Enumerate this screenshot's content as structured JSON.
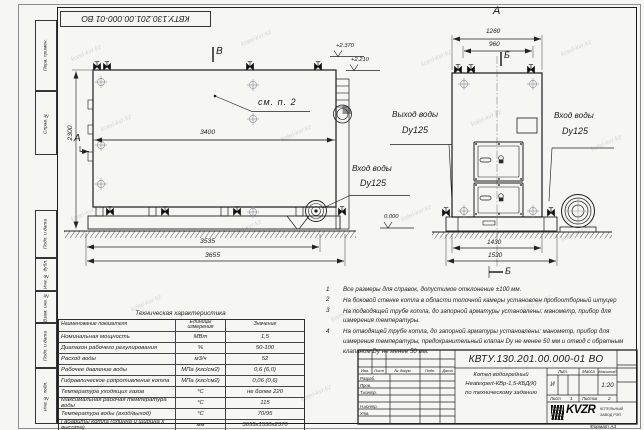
{
  "watermark": "kotel-kvr.kz",
  "frame": {
    "top_stamp": "КВТУ.130.201.00.000-01 ВО",
    "format_label": "Формат А3",
    "margin_labels": [
      "Перв. примен.",
      "Справ. №",
      "Подп. и дата",
      "Инв. № дубл.",
      "Взам. инв. №",
      "Подп. и дата",
      "Инв. № подл."
    ]
  },
  "side_view": {
    "mark_top": "В",
    "mark_left": "А",
    "see_note": "см. п. 2",
    "dims": {
      "width_inner": "3400",
      "height": "2300",
      "base": "3535",
      "overall": "3655"
    },
    "elevations": {
      "duct_top": "+2.370",
      "body_top": "+2.210",
      "ground": "0.000"
    },
    "inlet": {
      "line1": "Вход воды",
      "line2": "Dy125"
    }
  },
  "front_view": {
    "mark_top": "А",
    "section_top": "Б",
    "section_bottom": "Б",
    "dims": {
      "overall_width": "1260",
      "valve_spacing": "960",
      "base_width": "1430",
      "overall_base": "1530"
    },
    "outlet": {
      "line1": "Выход воды",
      "line2": "Dy125"
    },
    "inlet": {
      "line1": "Вход воды",
      "line2": "Dy125"
    }
  },
  "notes": {
    "items": [
      {
        "num": "1",
        "text": "Все размеры для справок, допустимое отклонение ±100 мм."
      },
      {
        "num": "2",
        "text": "На боковой стенке котла в области топочной камеры установлен пробоотборный штуцер"
      },
      {
        "num": "3",
        "text": "На подводящей трубе котла, до запорной арматуры установлены: манометр, прибор для измерения температуры."
      },
      {
        "num": "4",
        "text": "На отводящей трубе котла, до запорной арматуры установлены: манометр, прибор для измерения температуры, предохранительный клапан Dу не менее 50 мм и отвод с обратным клапаном Dу не менее 50 мм."
      }
    ]
  },
  "spec_table": {
    "title": "Техническая характеристика",
    "headers": {
      "name": "Наименование показателя",
      "units": "Единицы измерения",
      "value": "Значение"
    },
    "rows": [
      {
        "name": "Номинальная мощность",
        "units": "МВт",
        "value": "1,5"
      },
      {
        "name": "Диапазон рабочего регулирования",
        "units": "%",
        "value": "50-100"
      },
      {
        "name": "Расход воды",
        "units": "м3/ч",
        "value": "52"
      },
      {
        "name": "Рабочее давление воды",
        "units": "МПа (кгс/см2)",
        "value": "0,6 (6,0)"
      },
      {
        "name": "Гидравлическое сопротивление котла",
        "units": "МПа (кгс/см2)",
        "value": "0,06 (0,6)"
      },
      {
        "name": "Температура уходящих газов",
        "units": "°С",
        "value": "не более 220"
      },
      {
        "name": "Максимальная рабочая температура воды",
        "units": "°С",
        "value": "115"
      },
      {
        "name": "Температура воды (вход/выход)",
        "units": "°С",
        "value": "70/95"
      },
      {
        "name": "Габариты котла (длинна и ширина х высота)",
        "units": "мм",
        "value": "3655х1530х2370"
      }
    ]
  },
  "title_block": {
    "doc_number": "КВТУ.130.201.00.000-01 ВО",
    "description_line1": "Котел водогрейный",
    "description_line2": "Heatexpert-КВр-1,5-КБД(К)",
    "description_line3": "по техническому заданию",
    "sig_header": [
      "Изм.",
      "Лист",
      "№ докум.",
      "Подп.",
      "Дата"
    ],
    "sig_rows": [
      "Разраб.",
      "Пров.",
      "Т.контр.",
      "",
      "Н.контр.",
      "Утв."
    ],
    "lit_label": "Лит.",
    "lit_value": "И",
    "mass_label": "Масса",
    "scale_label": "Масштаб",
    "scale_value": "1:20",
    "sheet_label": "Лист",
    "sheet_value": "1",
    "sheets_label": "Листов",
    "sheets_value": "2",
    "logo_text": "KVZR",
    "logo_caption_line1": "КОТЕЛЬНЫЙ",
    "logo_caption_line2": "ЗАВОД РЭП"
  }
}
